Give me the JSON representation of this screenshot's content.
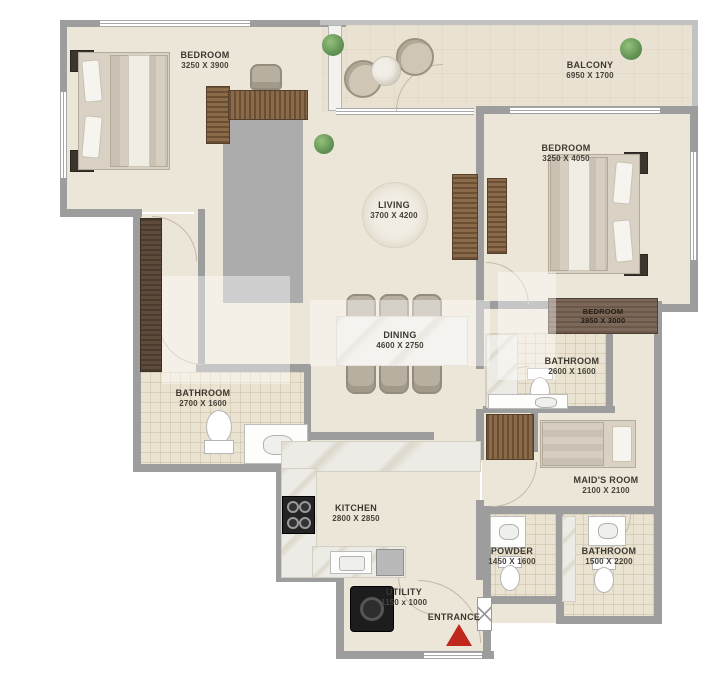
{
  "rooms": {
    "bedroom_1": {
      "name": "BEDROOM",
      "dims": "3250 X 3900"
    },
    "balcony": {
      "name": "BALCONY",
      "dims": "6950 X 1700"
    },
    "bedroom_2": {
      "name": "BEDROOM",
      "dims": "3250 X 4050"
    },
    "bedroom_3": {
      "name": "BEDROOM",
      "dims": "3950 X 3000"
    },
    "living": {
      "name": "LIVING",
      "dims": "3700 X 4200"
    },
    "dining": {
      "name": "DINING",
      "dims": "4600 X 2750"
    },
    "bathroom_1": {
      "name": "BATHROOM",
      "dims": "2700 X 1600"
    },
    "bathroom_2": {
      "name": "BATHROOM",
      "dims": "2600 X 1600"
    },
    "maids_room": {
      "name": "MAID'S ROOM",
      "dims": "2100 X 2100"
    },
    "powder": {
      "name": "POWDER",
      "dims": "1450 X 1600"
    },
    "bathroom_3": {
      "name": "BATHROOM",
      "dims": "1500 X 2200"
    },
    "kitchen": {
      "name": "KITCHEN",
      "dims": "2800 X 2850"
    },
    "utility": {
      "name": "UTILITY",
      "dims": "1150 x 1000"
    },
    "entrance": {
      "name": "ENTRANCE"
    }
  },
  "colors": {
    "wall": "#9d9d9d",
    "floor": "#ece6d8",
    "tile": "#eae3d1",
    "wood": "#7a5a3b",
    "entrance_arrow": "#c0281e",
    "pillow_blue": "#49799c",
    "pillow_orange": "#d09a70",
    "plant_green": "#6aa05b"
  },
  "icons": {
    "entrance_arrow": "triangle-up",
    "plant": "green-cluster",
    "washing_machine": "black-drum",
    "stove": "four-burners"
  }
}
